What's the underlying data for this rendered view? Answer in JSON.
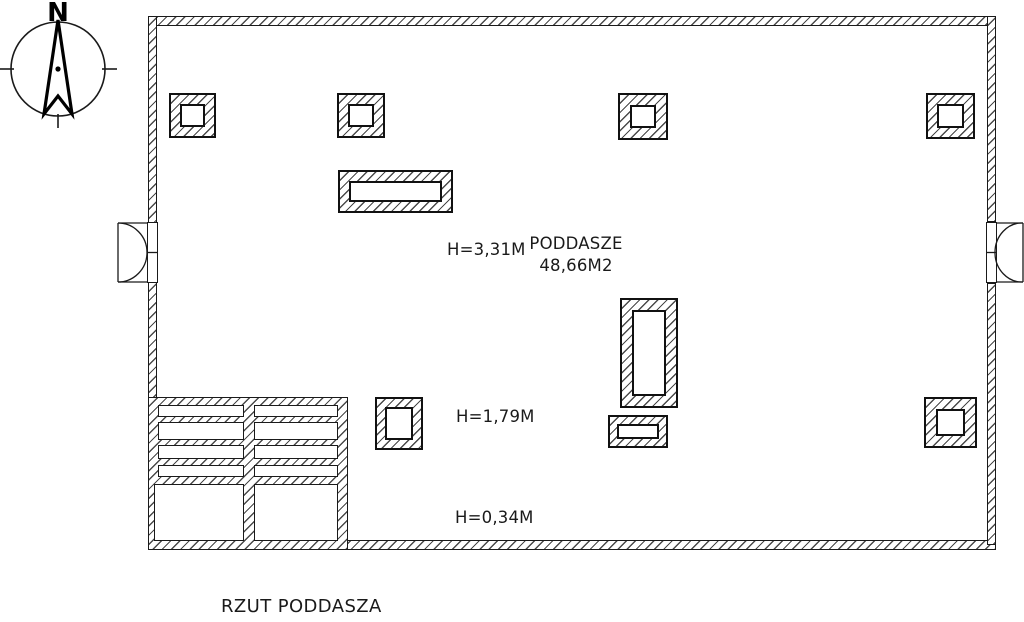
{
  "page": {
    "background": "#ffffff",
    "line_color": "#1a1a1a"
  },
  "compass": {
    "north_label": "N"
  },
  "plan": {
    "room_label": "PODDASZE",
    "room_area": "48,66M2",
    "height_upper": "H=3,31M",
    "height_mid": "H=1,79M",
    "height_low": "H=0,34M"
  },
  "caption": {
    "title": "RZUT PODDASZA"
  }
}
